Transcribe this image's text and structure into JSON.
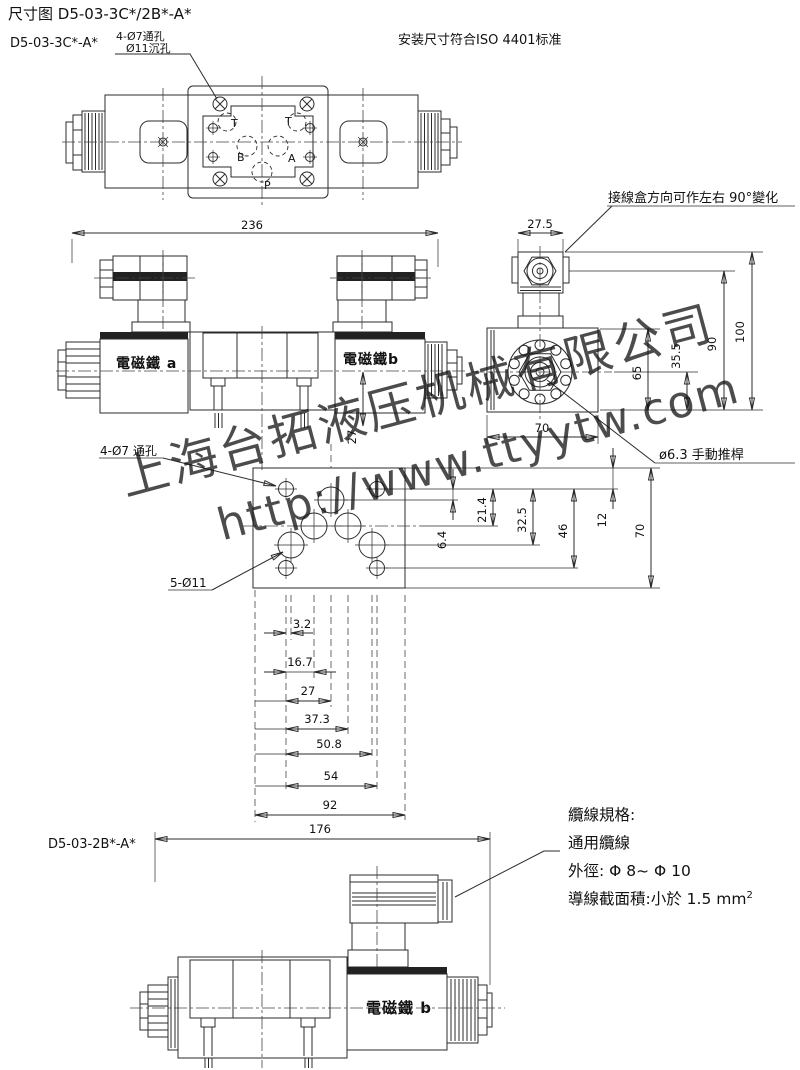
{
  "header": {
    "title": "尺寸图 D5-03-3C*/2B*-A*",
    "standard_note": "安装尺寸符合ISO 4401标准"
  },
  "models": {
    "model_3c": "D5-03-3C*-A*",
    "model_2b": "D5-03-2B*-A*"
  },
  "callouts": {
    "mount_holes_line1": "4-Ø7通孔",
    "mount_holes_line2": "Ø11沉孔",
    "junction_box": "接線盒方向可作左右 90°變化",
    "manual_pin": "ø6.3 手動推桿",
    "pattern_holes_small": "4-Ø7 通孔",
    "pattern_holes_large": "5-Ø11"
  },
  "labels": {
    "solenoid_a": "電磁鐵 a",
    "solenoid_b": "電磁鐵b",
    "solenoid_b_single": "電磁鐵 b",
    "port_t1": "T",
    "port_t2": "T",
    "port_b": "B",
    "port_a": "A",
    "port_p": "P"
  },
  "dimensions": {
    "overall_front": "236",
    "conn_width": "27.5",
    "h100": "100",
    "h90": "90",
    "h65": "65",
    "h35_5": "35.5",
    "side_width": "70",
    "front_offset": "27",
    "p6_4": "6.4",
    "p21_4": "21.4",
    "p32_5": "32.5",
    "p46": "46",
    "p12": "12",
    "p70": "70",
    "p3_2": "3.2",
    "p16_7": "16.7",
    "p27": "27",
    "p37_3": "37.3",
    "p50_8": "50.8",
    "p54": "54",
    "p92": "92",
    "overall_single": "176"
  },
  "cable_spec": {
    "line1": "纜線規格:",
    "line2": "通用纜線",
    "line3": "外徑: Φ 8~ Φ 10",
    "line4": "導線截面積:小於 1.5 mm",
    "line4_sup": "2"
  },
  "watermark": {
    "line1": "上海台拓液压机械有限公司",
    "line2": "http://www.ttyytw.com",
    "color": "#8ab5dd"
  },
  "colors": {
    "line": "#2b2b2b",
    "background": "#ffffff"
  }
}
